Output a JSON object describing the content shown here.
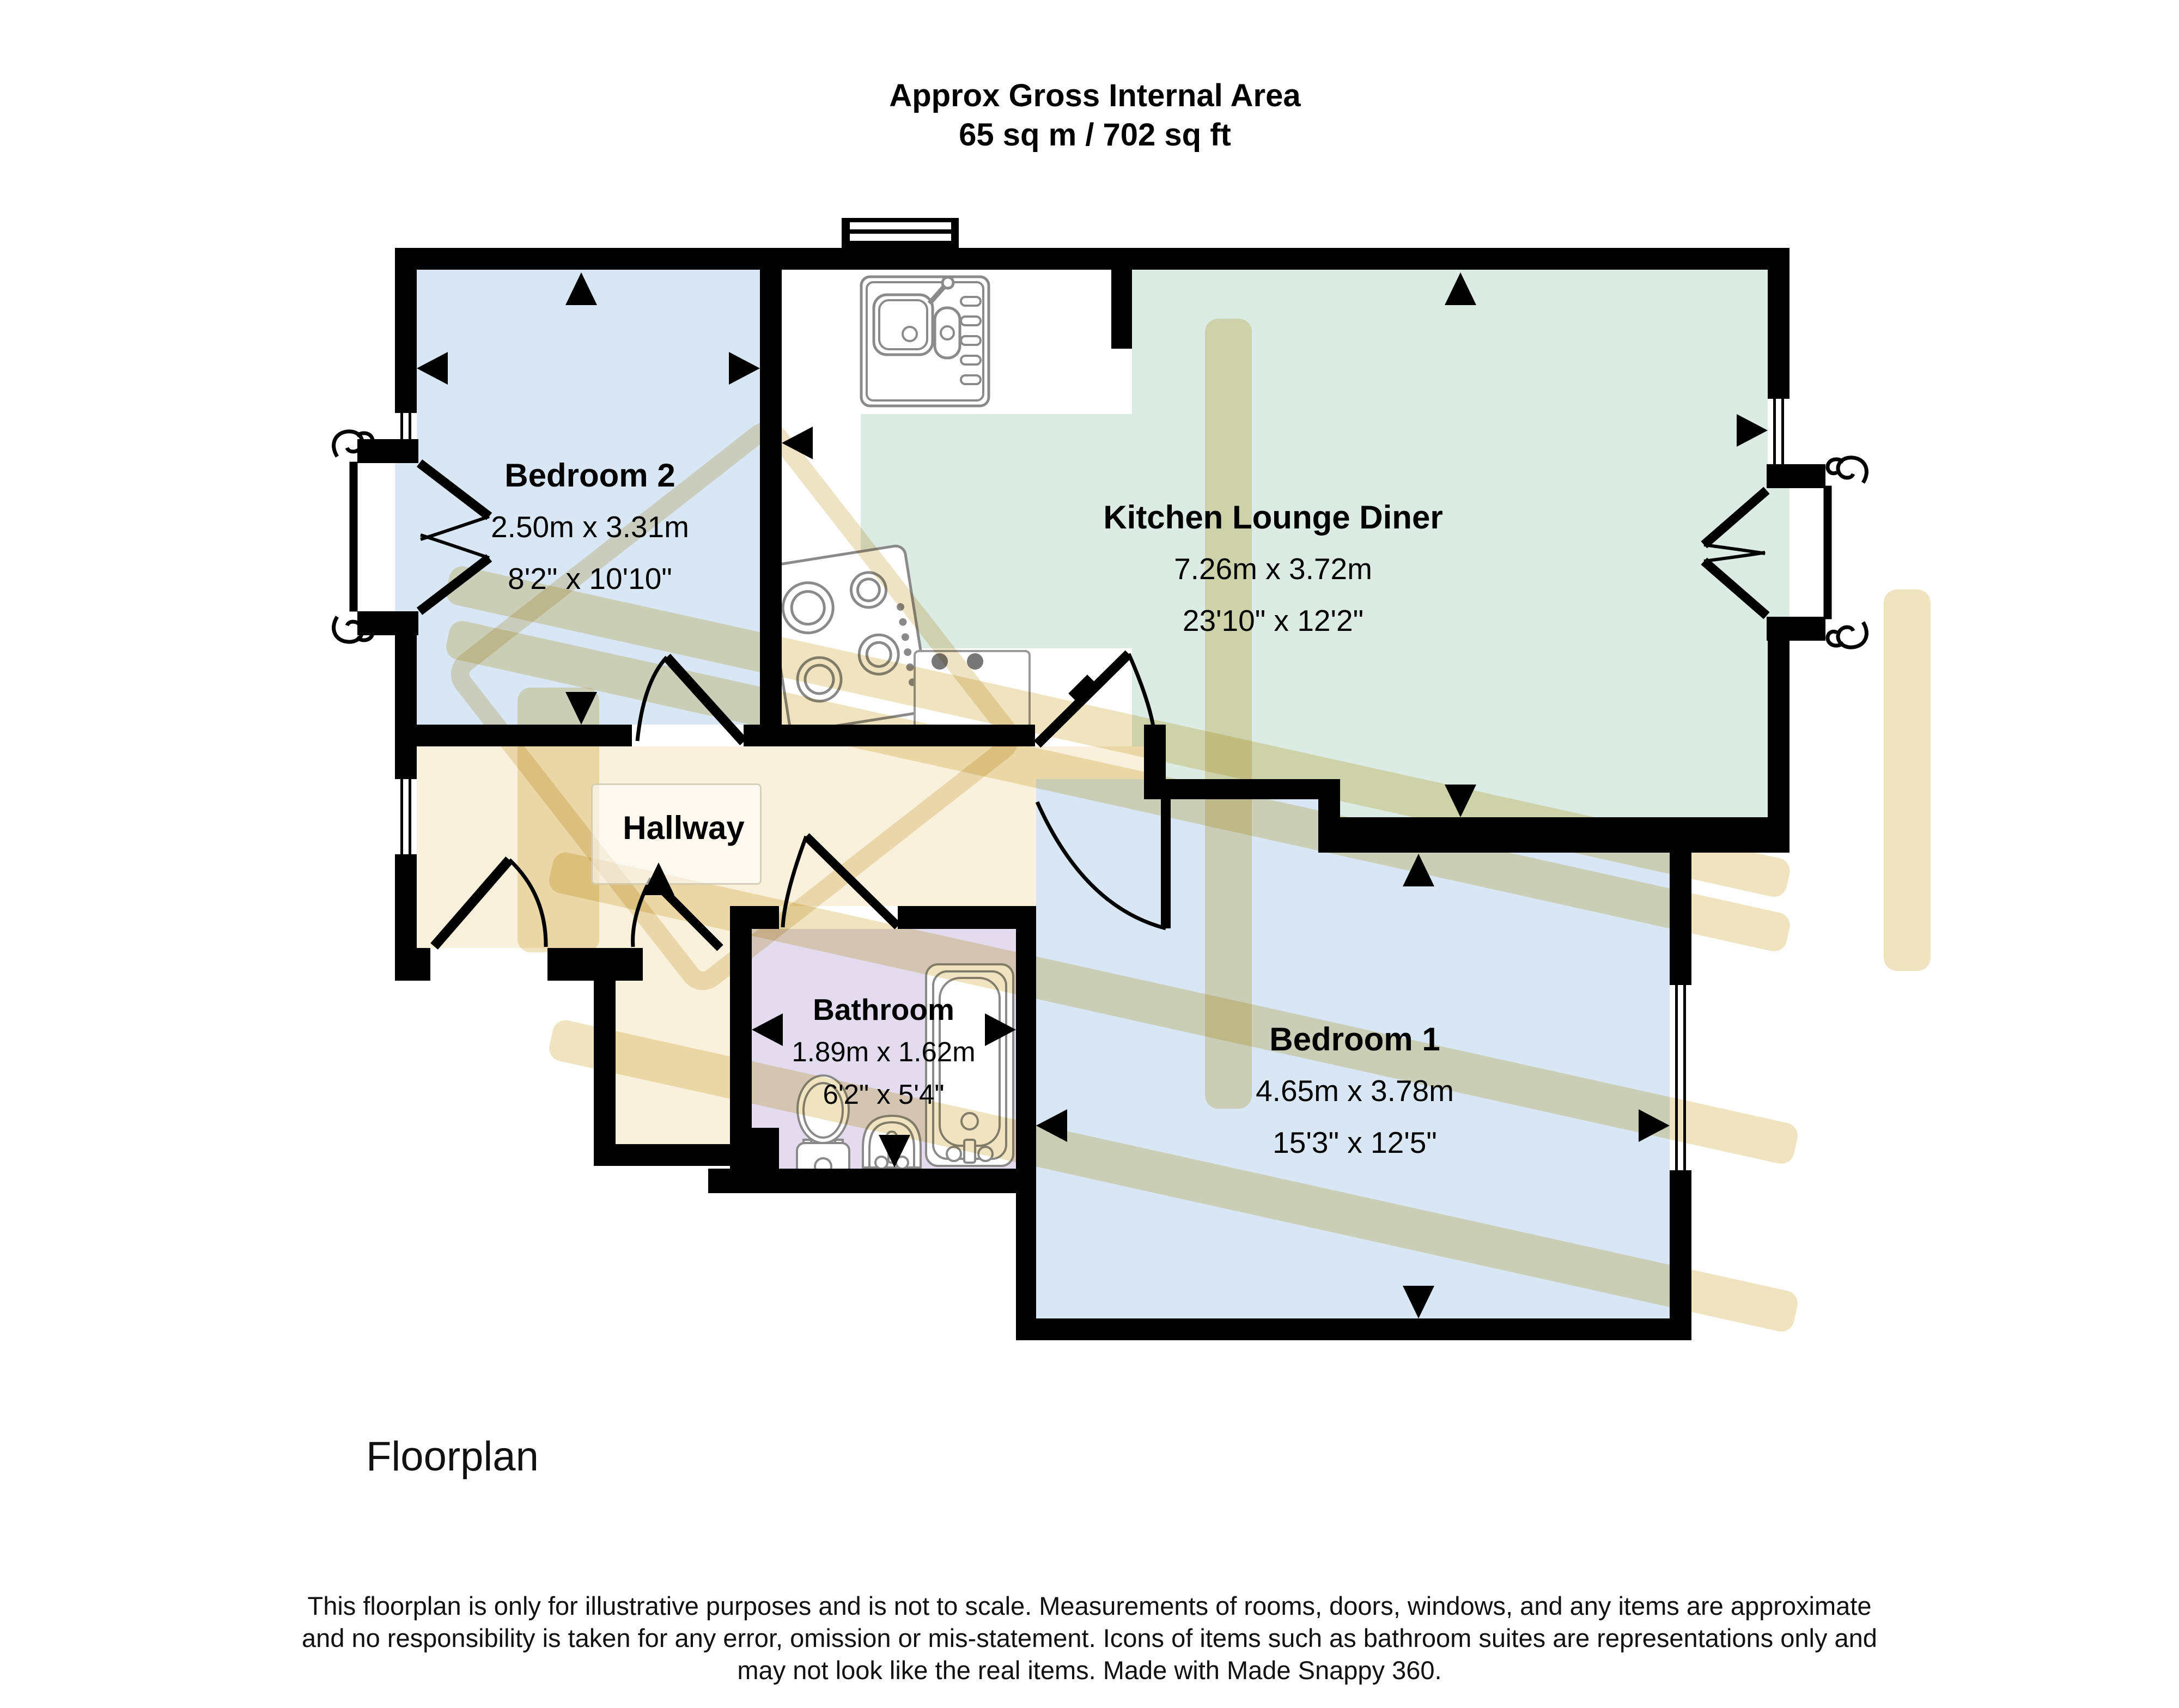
{
  "header": {
    "line1": "Approx Gross Internal Area",
    "line2": "65 sq m / 702 sq ft"
  },
  "rooms": {
    "bedroom2": {
      "name": "Bedroom 2",
      "metric": "2.50m x 3.31m",
      "imperial": "8'2\" x 10'10\""
    },
    "kitchen_lounge_diner": {
      "name": "Kitchen Lounge Diner",
      "metric": "7.26m x 3.72m",
      "imperial": "23'10\" x 12'2\""
    },
    "bedroom1": {
      "name": "Bedroom 1",
      "metric": "4.65m x 3.78m",
      "imperial": "15'3\" x 12'5\""
    },
    "bathroom": {
      "name": "Bathroom",
      "metric": "1.89m x 1.62m",
      "imperial": "6'2\" x 5'4\""
    },
    "hallway": {
      "name": "Hallway"
    }
  },
  "icons": [
    "kitchen-sink-icon",
    "stove-icon",
    "appliance-icon",
    "toilet-icon",
    "basin-icon",
    "bathtub-icon",
    "juliet-balcony-icon",
    "window-icon",
    "door-swing-icon",
    "dimension-arrow-icon",
    "watermark-logo"
  ],
  "footer": {
    "plan_label": "Floorplan",
    "disclaimer_line1": "This floorplan is only for illustrative purposes and is not to scale. Measurements of rooms, doors, windows, and any items are approximate",
    "disclaimer_line2": "and no responsibility is taken for any error, omission or mis-statement. Icons of items such as bathroom suites are representations only and",
    "disclaimer_line3": "may not look like the real items. Made with Made Snappy 360."
  },
  "colors": {
    "bedroom_floor": "#d9e7f5",
    "kitchen_lounge_floor": "#dcebe3",
    "hallway_floor": "#faf1dc",
    "bathroom_floor": "#e3dcee",
    "kitchen_strip_floor": "#ffffff",
    "wall": "#000000",
    "fixture_outline": "#8a8a8a",
    "watermark": "#e2cd8a"
  }
}
